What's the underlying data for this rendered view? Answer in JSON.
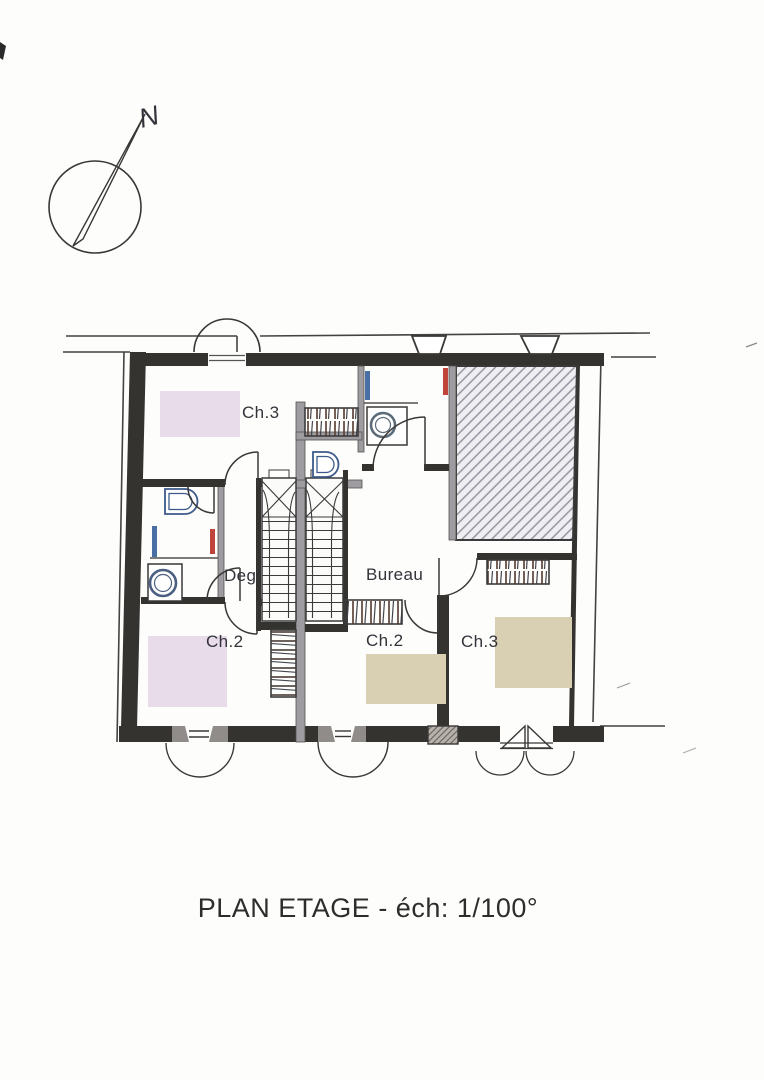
{
  "compass": {
    "label": "N"
  },
  "plan": {
    "rooms": [
      {
        "id": "bedroom-top-left",
        "label": "Ch.3"
      },
      {
        "id": "hallway",
        "label": "Degt"
      },
      {
        "id": "bedroom-bottom-left",
        "label": "Ch.2"
      },
      {
        "id": "office",
        "label": "Bureau"
      },
      {
        "id": "bedroom-bottom-middle",
        "label": "Ch.2"
      },
      {
        "id": "bedroom-bottom-right",
        "label": "Ch.3"
      }
    ],
    "colors": {
      "bed_pink": "#e8dcea",
      "bed_beige": "#d9cfb3",
      "wall_dark": "#35332f",
      "partition_gray": "#9e9ba1",
      "radiator_red": "#c0443c",
      "fixture_blue": "#4a6fa5",
      "hatch_gray": "#8f8f9a",
      "wardrobe_brown": "#5d4339"
    }
  },
  "caption": {
    "title": "PLAN ETAGE - éch: 1/100°"
  }
}
